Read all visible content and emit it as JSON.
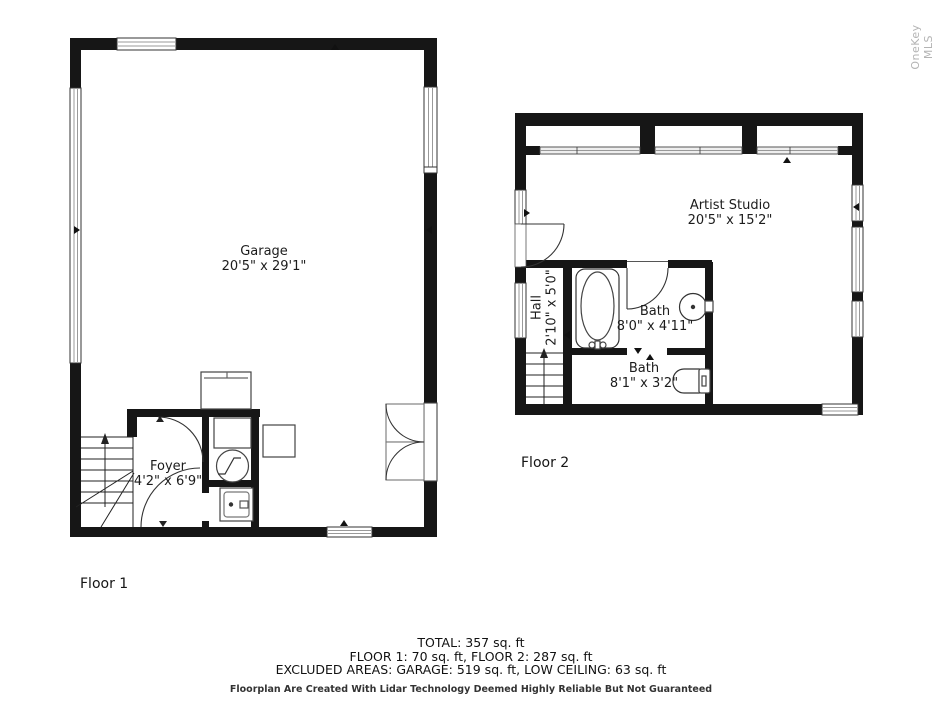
{
  "watermark": "OneKey MLS",
  "floor1": {
    "label": "Floor 1",
    "rooms": {
      "garage": {
        "name": "Garage",
        "dims": "20'5\" x 29'1\""
      },
      "foyer": {
        "name": "Foyer",
        "dims": "4'2\" x 6'9\""
      }
    }
  },
  "floor2": {
    "label": "Floor 2",
    "rooms": {
      "artist_studio": {
        "name": "Artist Studio",
        "dims": "20'5\" x 15'2\""
      },
      "hall": {
        "name": "Hall",
        "dims": "2'10\" x 5'0\""
      },
      "bath1": {
        "name": "Bath",
        "dims": "8'0\" x 4'11\""
      },
      "bath2": {
        "name": "Bath",
        "dims": "8'1\" x 3'2\""
      }
    }
  },
  "summary": {
    "total": "TOTAL: 357 sq. ft",
    "floors": "FLOOR 1: 70 sq. ft, FLOOR 2: 287 sq. ft",
    "excluded": "EXCLUDED AREAS: GARAGE: 519 sq. ft, LOW CEILING: 63 sq. ft",
    "disclaimer": "Floorplan Are Created With Lidar Technology Deemed Highly Reliable But Not Guaranteed"
  },
  "colors": {
    "wall": "#161616",
    "window_line": "#999999",
    "watermark": "#b3b3b3"
  }
}
